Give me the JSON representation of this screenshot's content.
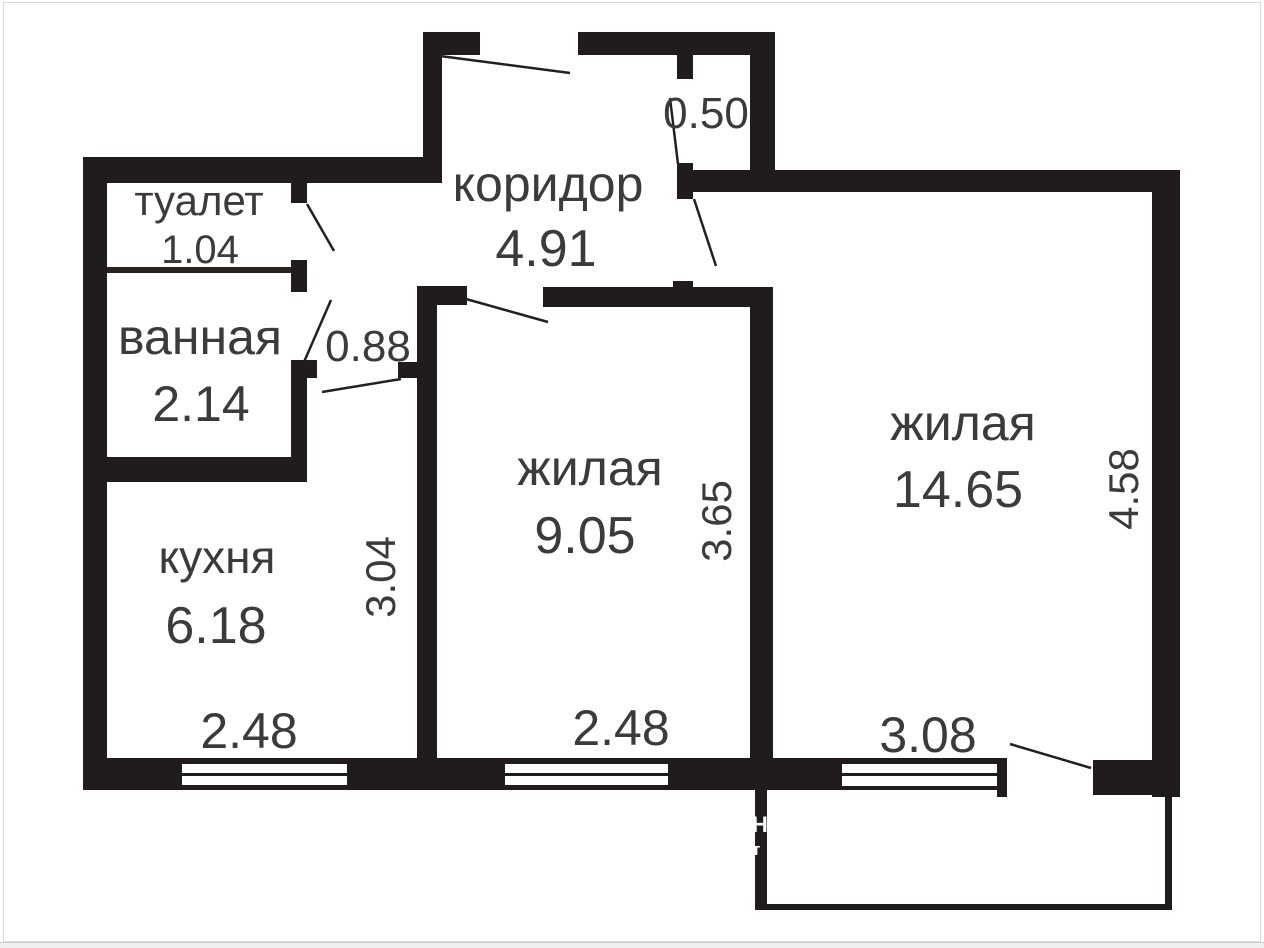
{
  "floorplan": {
    "rooms": [
      {
        "name": "туалет",
        "area": "1.04"
      },
      {
        "name": "ванная",
        "area": "2.14"
      },
      {
        "name": "коридор",
        "area": "4.91"
      },
      {
        "name": "кухня",
        "area": "6.18"
      },
      {
        "name": "жилая",
        "area": "9.05"
      },
      {
        "name": "жилая",
        "area": "14.65"
      }
    ],
    "dimensions": {
      "niche": "0.50",
      "passage": "0.88",
      "kitchen_depth": "3.04",
      "kitchen_width": "2.48",
      "room1_depth": "3.65",
      "room1_width": "2.48",
      "room2_depth": "4.58",
      "room2_width": "3.08"
    },
    "watermark_fragments": [
      "Н",
      "т"
    ],
    "colors": {
      "wall": "#201b1d",
      "text": "#3b3b3b",
      "background": "#ffffff",
      "frame": "#dcdcdc"
    }
  }
}
